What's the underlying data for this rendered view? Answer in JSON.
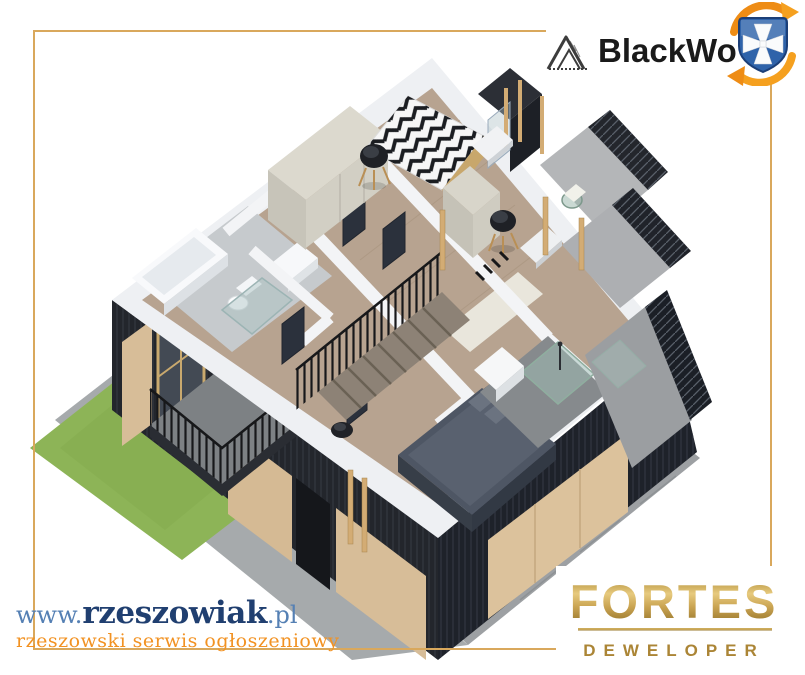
{
  "header": {
    "brand": {
      "icon": "mountain-peak-logo",
      "label": "BlackWo"
    },
    "badge_icon": "rzeszow-crest-badge",
    "badge_colors": {
      "shield_blue": "#2f63aa",
      "arrow_orange": "#ee8c15",
      "cross_white": "#fafbfc"
    }
  },
  "watermark": {
    "prefix": "www.",
    "name": "rzeszowiak",
    "tld": ".pl",
    "tagline": "rzeszowski serwis ogłoszeniowy",
    "name_color": "#203f70",
    "accent_color": "#5580b4",
    "tagline_color": "#f29222"
  },
  "developer": {
    "name": "FORTES",
    "subtitle": "DEWELOPER",
    "gold": "#ab8536"
  },
  "frame": {
    "color": "#d9a85c"
  },
  "floor_plan": {
    "type": "isometric-3d-render-upper-floor",
    "features": [
      "chevron-pattern-bed",
      "black-round-chairs",
      "wardrobes",
      "bathroom-tub-toilet-shower",
      "staircase-with-black-railing",
      "navy-double-bed",
      "glass-shower-bathroom",
      "tiled-terraces",
      "balcony-black-railing",
      "dark-timber-facade",
      "wood-cladding-panels",
      "grass-patch",
      "paved-ground"
    ],
    "colors": {
      "facade_navy": "#22252b",
      "wood_panel": "#d7bd98",
      "floor_wood": "#b7a390",
      "wall_white": "#eef0f3",
      "tile_gray": "#b4b6b8",
      "grass_green": "#8db457",
      "pavement": "#a6aaac",
      "railing_black": "#17181a",
      "bed_navy": "#4e5664",
      "wardrobe_beige": "#dcd9ce",
      "post_tan": "#d3ac74"
    }
  }
}
